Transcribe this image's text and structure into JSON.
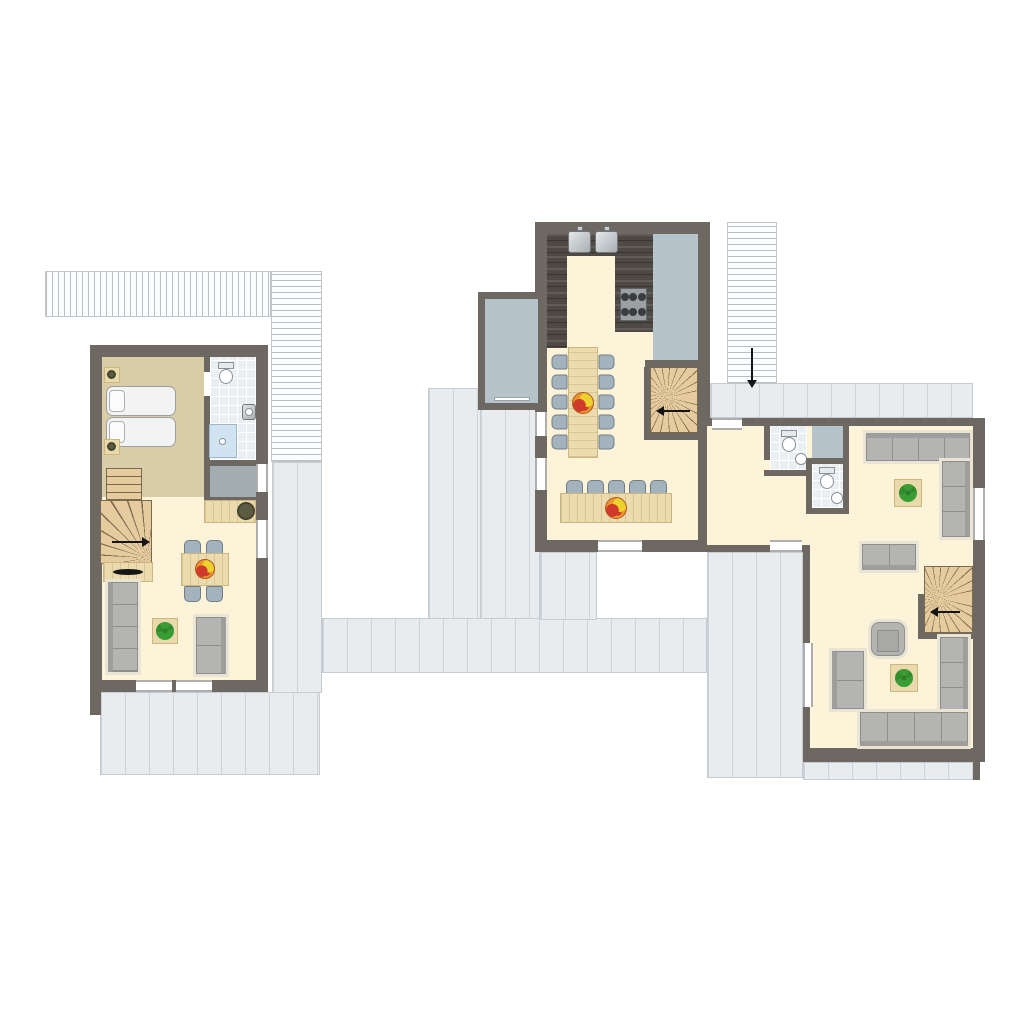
{
  "title": "holiday-home-upper-floor-plan",
  "colors": {
    "bg": "#ffffff",
    "wall": "#6e6862",
    "cream": "#fcf3d8",
    "tan": "#d9cda8",
    "tile": "#e9eff3",
    "vest": "#a3acb1",
    "voidGrey": "#b6c3ca",
    "deckFill": "#e8ecef",
    "deckLine": "#ccd4d9",
    "deckEdge": "#c6cdd2",
    "walkLine": "#b9bfc3",
    "walkEdge": "#c2c6c9",
    "counter": "#4e4944",
    "wood": "#ecdbae",
    "woodPale": "#e9d9ad",
    "stairWood": "#e5cb9e",
    "stairLine": "#7a6a50",
    "sofa": "#b4b4b2",
    "sofaLine": "#8e8e8c",
    "sofaHalo": "#eae4d4",
    "chair": "#a3b2bd",
    "chairLine": "#6f7e88",
    "shower": "#cfe4f0",
    "plant": "#3d9b37",
    "fruitRed": "#cf3a2a",
    "fruitOrange": "#e9972e",
    "fruitYellow": "#ecd12f",
    "olive": "#5c5c42"
  },
  "plan": {
    "type": "floor-plan",
    "text_labels": [],
    "buildings": [
      {
        "name": "left-unit",
        "rooms": [
          "bedroom",
          "bathroom",
          "vestibule",
          "living-room"
        ],
        "furniture": [
          "double-bed",
          "nightstand-with-lamp-x2",
          "toilet",
          "washbasin",
          "shower",
          "staircase-with-winder",
          "counter-with-round-unit",
          "tv-sideboard",
          "dining-table-4-chairs",
          "fruit-bowl",
          "sofa-4-seat",
          "sofa-2-seat",
          "plant-table"
        ]
      },
      {
        "name": "middle-unit",
        "rooms": [
          "kitchen",
          "dining-room",
          "loggia-left",
          "void-right"
        ],
        "furniture": [
          "u-shaped-kitchen-counter",
          "double-sink",
          "hob-6-burner",
          "long-dining-table-10-chairs",
          "serving-table-5-chairs",
          "fruit-bowl-x2",
          "winder-staircase-down"
        ]
      },
      {
        "name": "right-unit",
        "rooms": [
          "hallway",
          "wc-1",
          "wc-2",
          "shaft",
          "lounge"
        ],
        "furniture": [
          "toilet-x2",
          "washbasin-x2",
          "corner-sofa-top",
          "corner-sofa-bottom",
          "sofa-2-seat-x2",
          "armchair",
          "plant-table-x2",
          "winder-staircase-down"
        ]
      }
    ],
    "outdoor": [
      "roof-deck-between-units",
      "deck-below-left-unit",
      "deck-below-right-unit",
      "upper-walkway-top-left",
      "external-stair-top-right-with-down-arrow"
    ],
    "arrows": [
      {
        "name": "external-stair-arrow",
        "direction": "down"
      },
      {
        "name": "left-unit-stair-arrow",
        "direction": "right"
      },
      {
        "name": "middle-unit-stair-arrow",
        "direction": "left"
      },
      {
        "name": "right-unit-stair-arrow",
        "direction": "left"
      }
    ]
  }
}
